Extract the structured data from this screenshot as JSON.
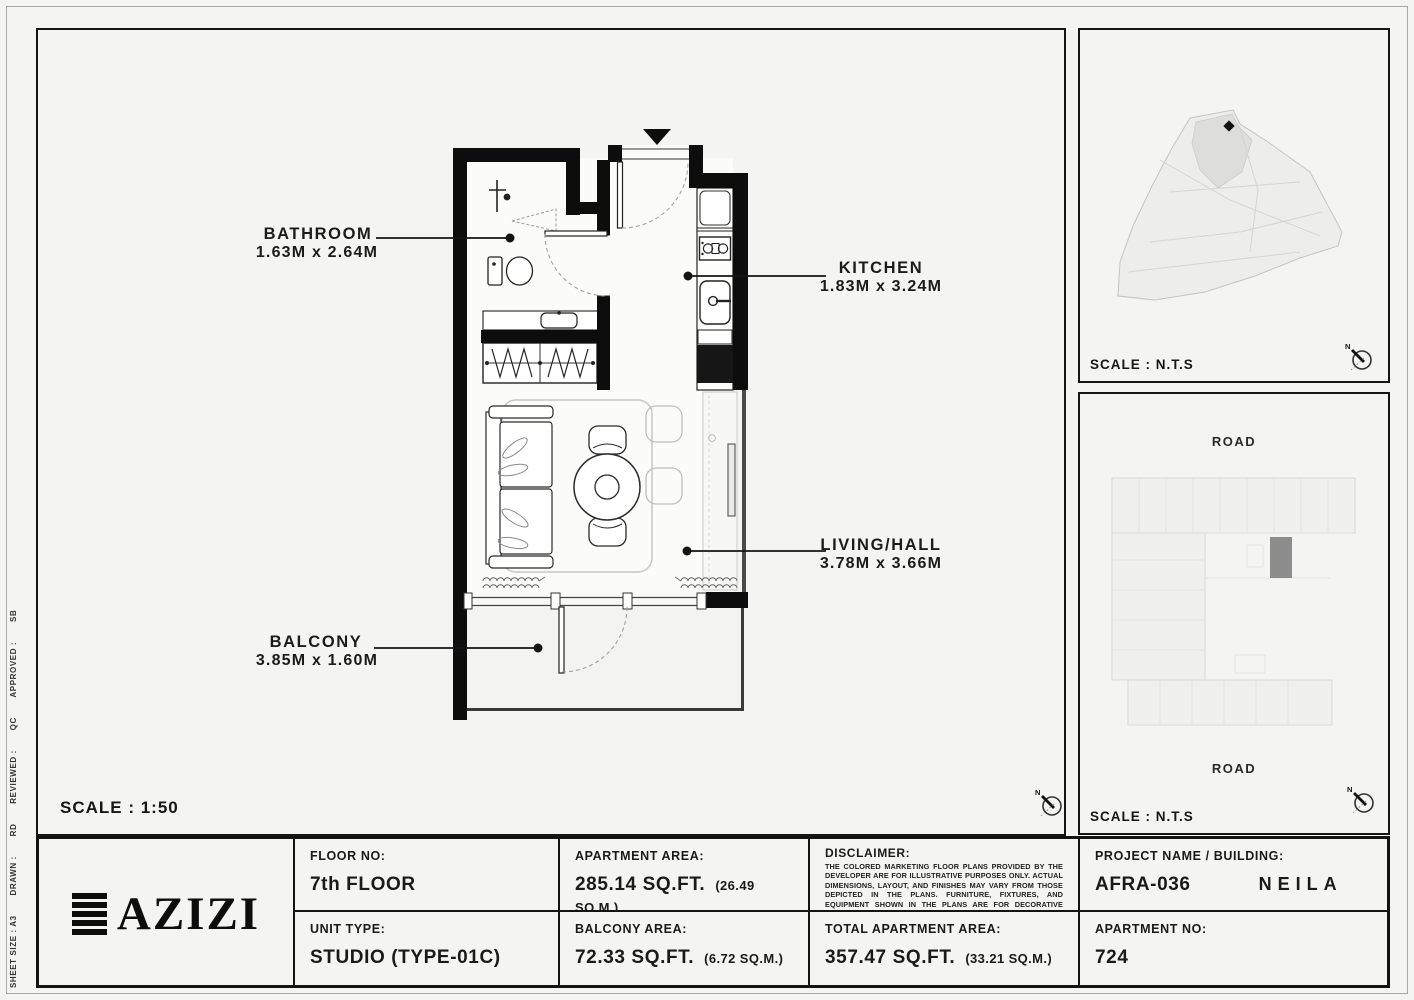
{
  "colors": {
    "background": "#f4f4f2",
    "wall": "#0d0d0d",
    "highlight_unit": "#8d8d8d",
    "border": "#151515"
  },
  "side_strip": {
    "sheet_size": "SHEET SIZE : A3",
    "drawn_label": "DRAWN :",
    "drawn_value": "RD",
    "reviewed_label": "REVIEWED :",
    "reviewed_value": "QC",
    "approved_label": "APPROVED :",
    "approved_value": "SB"
  },
  "main_plan": {
    "scale_text": "SCALE : 1:50",
    "compass_n": "N",
    "labels": {
      "bathroom": {
        "name": "BATHROOM",
        "dims": "1.63M x 2.64M"
      },
      "kitchen": {
        "name": "KITCHEN",
        "dims": "1.83M x 3.24M"
      },
      "living": {
        "name": "LIVING/HALL",
        "dims": "3.78M x 3.66M"
      },
      "balcony": {
        "name": "BALCONY",
        "dims": "3.85M x 1.60M"
      }
    }
  },
  "site_map": {
    "scale_text": "SCALE : N.T.S"
  },
  "building_map": {
    "scale_text": "SCALE : N.T.S",
    "road_top": "ROAD",
    "road_bottom": "ROAD"
  },
  "footer": {
    "logo_text": "AZIZI",
    "floor": {
      "label": "FLOOR NO:",
      "value": "7th FLOOR"
    },
    "unit": {
      "label": "UNIT TYPE:",
      "value": "STUDIO (TYPE-01C)"
    },
    "apartment_area": {
      "label": "APARTMENT AREA:",
      "value": "285.14 SQ.FT.",
      "metric": "(26.49 SQ.M.)"
    },
    "balcony_area": {
      "label": "BALCONY AREA:",
      "value": "72.33 SQ.FT.",
      "metric": "(6.72 SQ.M.)"
    },
    "disclaimer": {
      "label": "DISCLAIMER:",
      "text": "THE COLORED MARKETING FLOOR PLANS PROVIDED BY THE DEVELOPER ARE FOR ILLUSTRATIVE PURPOSES ONLY. ACTUAL DIMENSIONS, LAYOUT, AND FINISHES MAY VARY FROM THOSE DEPICTED IN THE PLANS. FURNITURE, FIXTURES, AND EQUIPMENT SHOWN IN THE PLANS ARE FOR DECORATIVE PURPOSES ONLY AND ARE NOT INCLUDED IN THE PURCHASE OR LEASE OF THE PROPERTY. THE DEVELOPER RESERVES THE RIGHT TO MAKE MODIFICATIONS, REVISIONS, AND CHANGES TO THE FLOOR PLANS, SPECIFICATIONS, AND FEATURES WITHOUT PRIOR NOTICE."
    },
    "total_area": {
      "label": "TOTAL APARTMENT AREA:",
      "value": "357.47 SQ.FT.",
      "metric": "(33.21 SQ.M.)"
    },
    "project": {
      "label": "PROJECT NAME / BUILDING:",
      "value": "AFRA-036",
      "building": "NEILA"
    },
    "apartment_no": {
      "label": "APARTMENT NO:",
      "value": "724"
    }
  }
}
